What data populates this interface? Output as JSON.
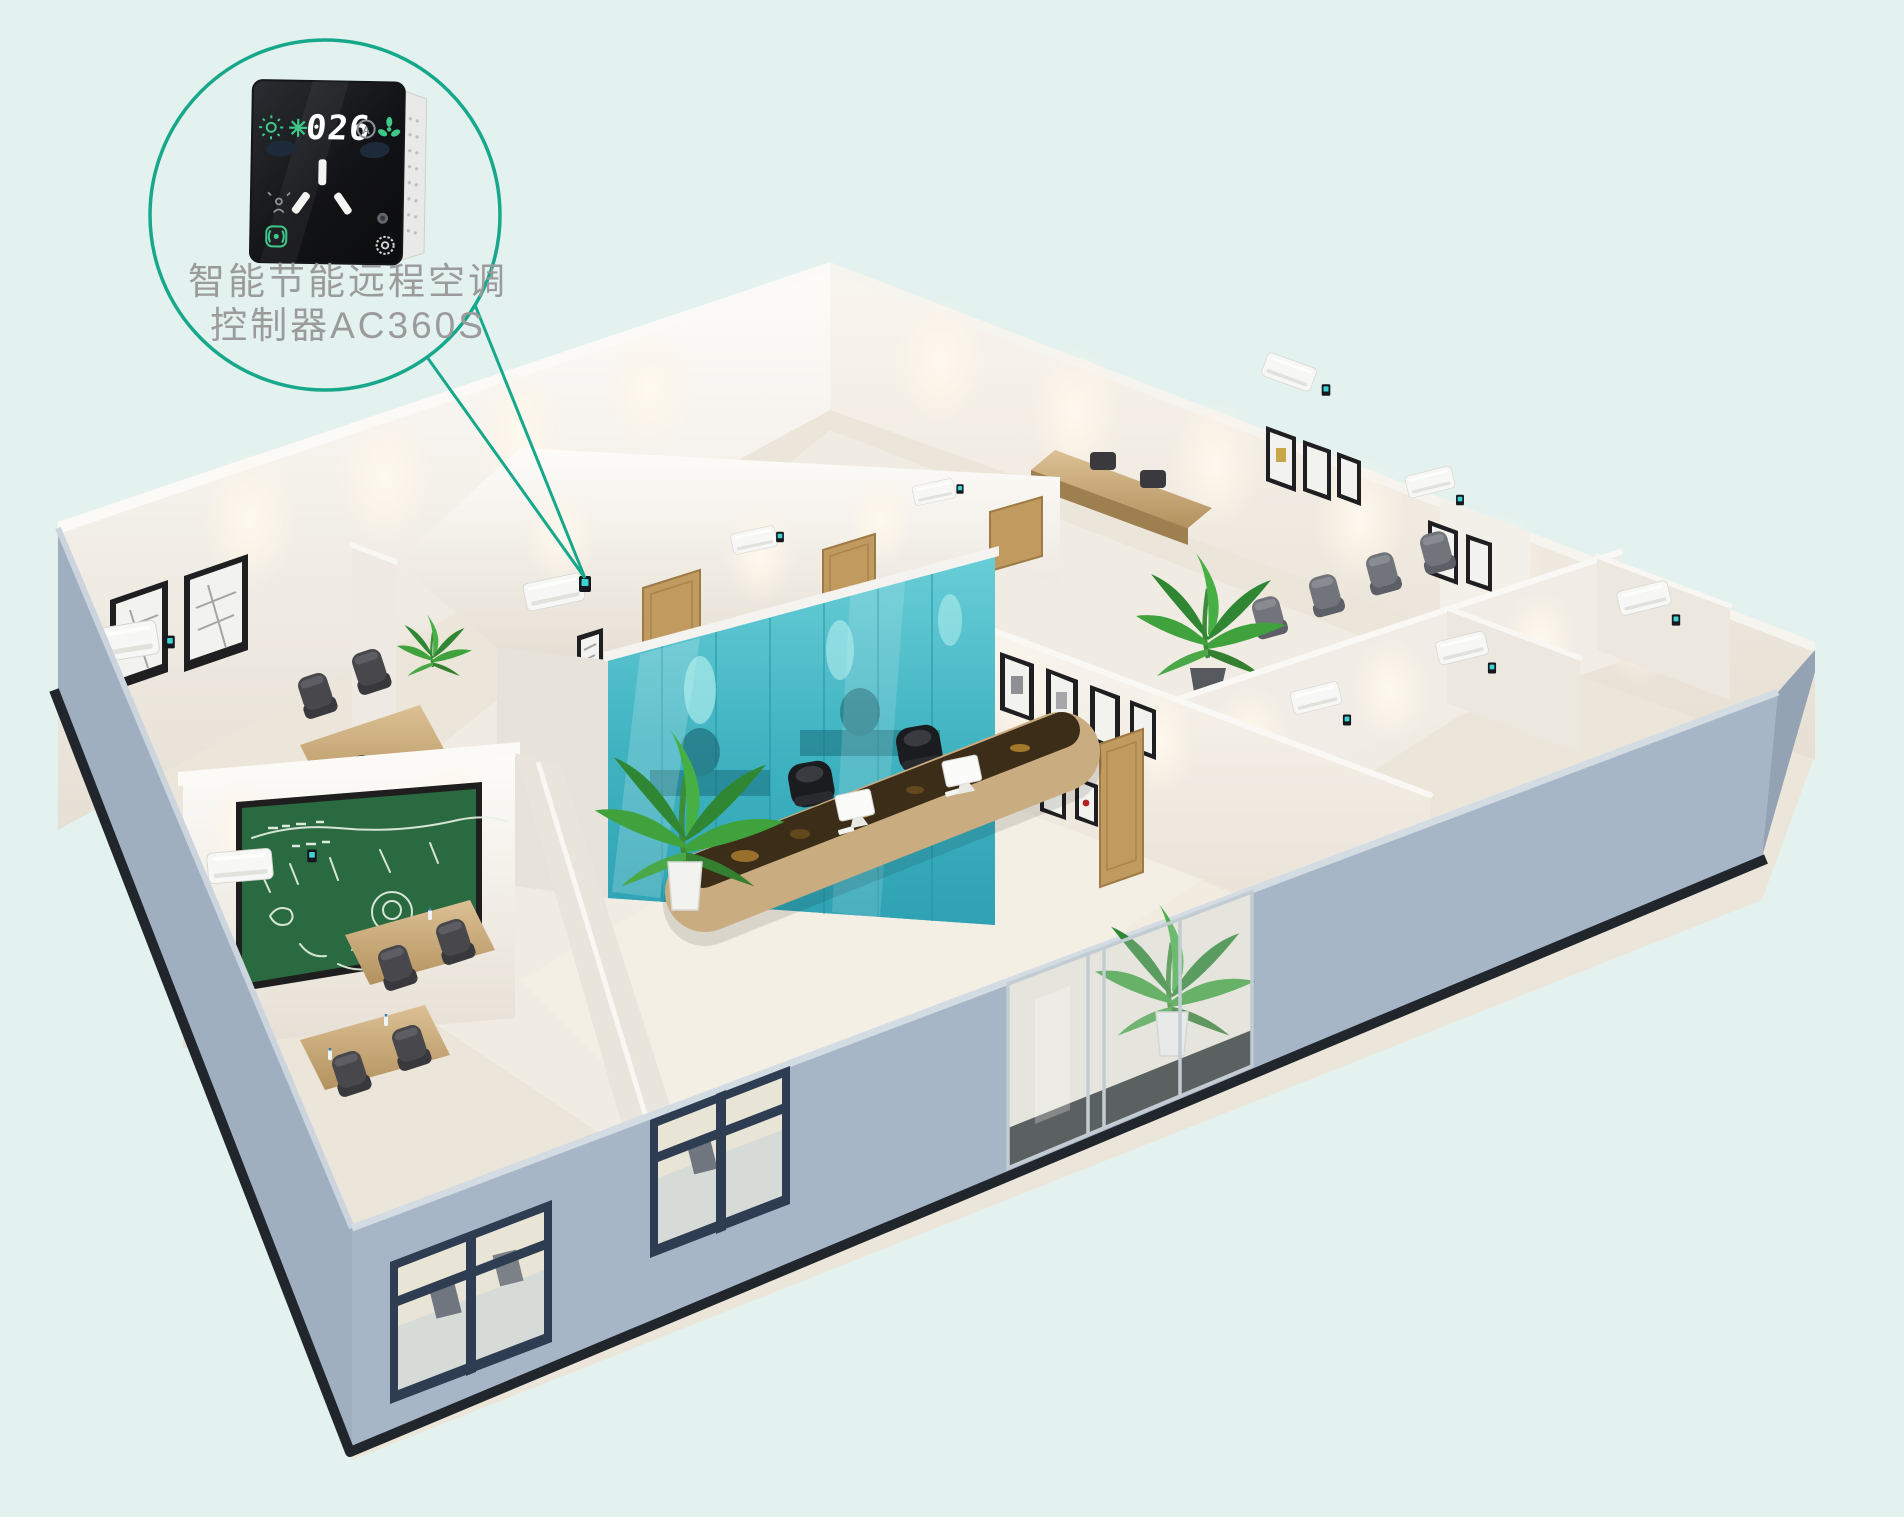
{
  "background_color": "#e3f2ee",
  "accent": {
    "callout_stroke": "#17a88c"
  },
  "callout": {
    "label_line1": "智能节能远程空调",
    "label_line2": "控制器AC360S",
    "device": {
      "display_value": "026",
      "body_color": "#141619",
      "icon_green": "#3ec98a",
      "icons": [
        "sun-icon",
        "snowflake-icon",
        "auto-mode-icon",
        "fan-icon",
        "presence-sensor-icon",
        "remote-link-icon",
        "indicator-led",
        "settings-gear-icon"
      ]
    }
  },
  "scene": {
    "exterior_wall_color": "#a7b6c6",
    "interior_wall_color": "#f6f2ec",
    "floor_color": "#ece6da",
    "glass_partition_color": "#41b4c2",
    "chalkboard_color": "#2a6a41",
    "wood_color": "#c9ac80",
    "counter_marble_color": "#3b2d18",
    "door_wood_color": "#c09a5e",
    "ac_unit_color": "#f7f7f5",
    "controller_screen_color": "#3fd2d4",
    "office_chair_color": "#47474c",
    "meeting_chair_color": "#71747a",
    "executive_chair_color": "#1b1c1f",
    "plant_color": "#3fa23c",
    "window_frame_color": "#33435a"
  }
}
